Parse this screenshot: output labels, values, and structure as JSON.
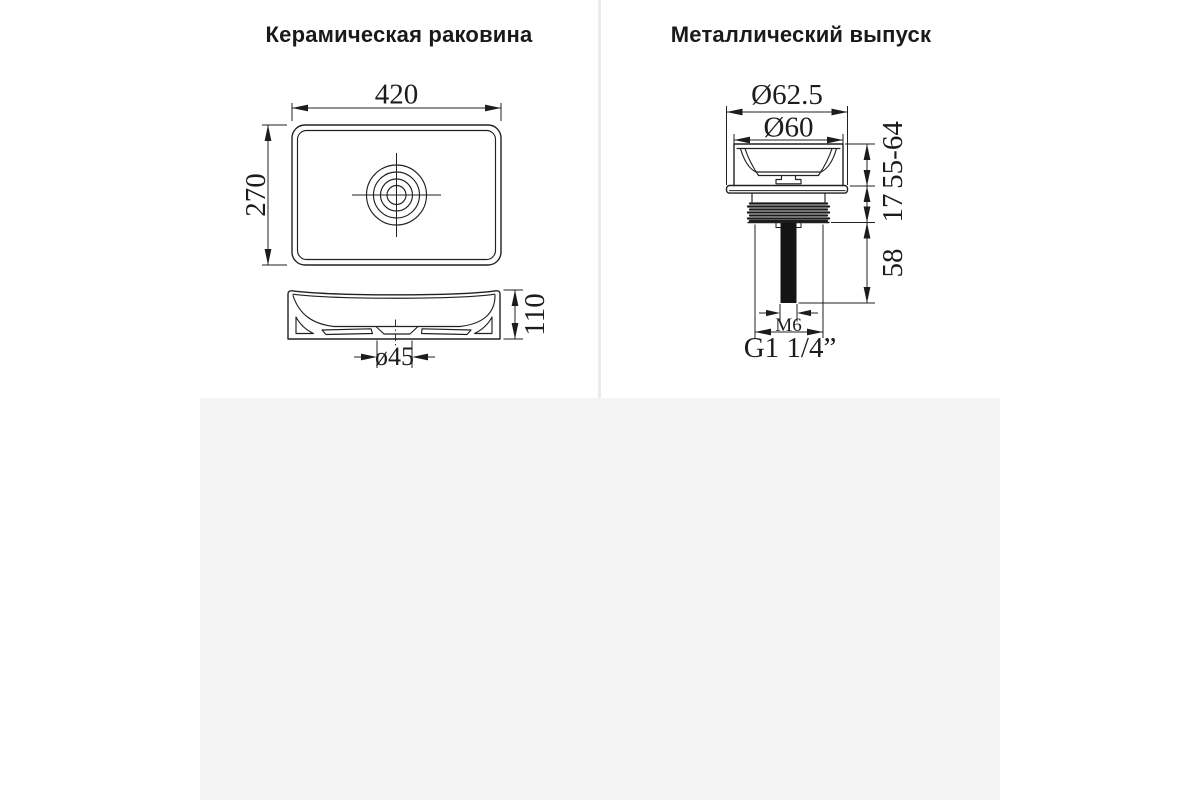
{
  "colors": {
    "background": "#ffffff",
    "lower_section_bg": "#f4f4f4",
    "divider": "#ebebeb",
    "line": "#212121",
    "title_text": "#1a1a1a"
  },
  "left_panel": {
    "title": "Керамическая раковина",
    "dims": {
      "width": "420",
      "depth": "270",
      "height": "110",
      "drain_diameter": "ø45"
    }
  },
  "right_panel": {
    "title": "Металлический выпуск",
    "dims": {
      "flange_outer": "Ø62.5",
      "flange_inner": "Ø60",
      "height_range": "55-64",
      "thread_height": "17",
      "tail_length": "58",
      "screw": "M6",
      "thread_size": "G1 1/4”"
    }
  }
}
